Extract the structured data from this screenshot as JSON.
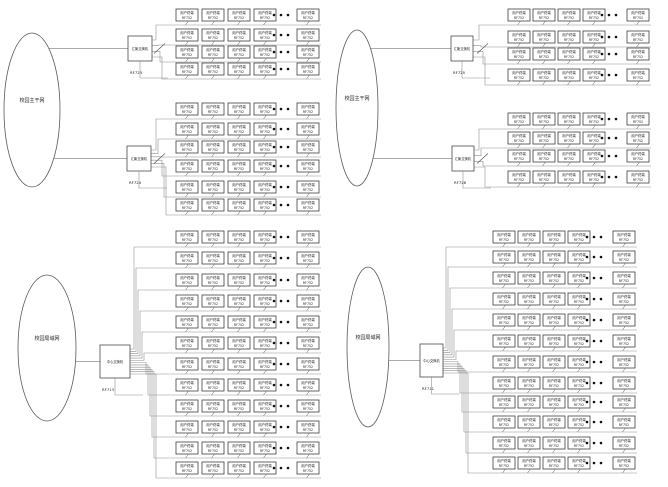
{
  "canvas": {
    "w": 668,
    "h": 487,
    "bg": "#ffffff"
  },
  "styles": {
    "wire_color": "#8f8f8f",
    "wire_width": 0.6,
    "box_stroke": "#3f3f3f",
    "box_fill": "#ffffff",
    "text_color": "#1c1c1c",
    "ellipse_stroke": "#5a5a5a",
    "dot_color": "#111111"
  },
  "terminal_box": {
    "w": 22,
    "h": 12,
    "line1": "用户终端",
    "line2": "RF752"
  },
  "clusters": [
    {
      "id": "top-left",
      "ellipse": {
        "cx": 32,
        "cy": 110,
        "rx": 28,
        "ry": 77,
        "label": "校园主干网"
      },
      "row_geo": {
        "box_xs": [
          176,
          202,
          228,
          254
        ],
        "dots_cx": 281,
        "last_x": 297,
        "bus_end": 321
      },
      "groups": [
        {
          "switch": {
            "x": 128,
            "y": 36,
            "w": 24,
            "h": 25,
            "label": "汇聚交换机",
            "sublabel": "RF723"
          },
          "riser_base": 156,
          "slash": true,
          "rows": [
            9,
            29,
            46,
            63
          ]
        },
        {
          "switch": {
            "x": 127,
            "y": 146,
            "w": 24,
            "h": 25,
            "label": "汇聚交换机",
            "sublabel": "RF724"
          },
          "riser_base": 156,
          "slash": true,
          "rows": [
            103,
            123,
            141,
            160,
            181,
            199
          ]
        }
      ]
    },
    {
      "id": "top-right",
      "ellipse": {
        "cx": 357,
        "cy": 108,
        "rx": 21,
        "ry": 78,
        "label": "校园主干网"
      },
      "row_geo": {
        "box_xs": [
          508,
          533,
          558,
          583
        ],
        "dots_cx": 609,
        "last_x": 627,
        "bus_end": 651
      },
      "groups": [
        {
          "switch": {
            "x": 451,
            "y": 36,
            "w": 22,
            "h": 25,
            "label": "汇聚交换机",
            "sublabel": "RF725"
          },
          "riser_base": 479,
          "slash": true,
          "rows": [
            9,
            31,
            48,
            69
          ]
        },
        {
          "switch": {
            "x": 452,
            "y": 146,
            "w": 22,
            "h": 25,
            "label": "汇聚交换机",
            "sublabel": "RF726"
          },
          "riser_base": 479,
          "slash": true,
          "rows": [
            113,
            132,
            150,
            171
          ]
        }
      ]
    },
    {
      "id": "bottom-left",
      "ellipse": {
        "cx": 47,
        "cy": 348,
        "rx": 29,
        "ry": 73,
        "label": "校园局域网"
      },
      "row_geo": {
        "box_xs": [
          176,
          202,
          228,
          254
        ],
        "dots_cx": 281,
        "last_x": 297,
        "bus_end": 321
      },
      "groups": [
        {
          "switch": {
            "x": 100,
            "y": 345,
            "w": 30,
            "h": 33,
            "label": "中心交换机",
            "sublabel": "RF713"
          },
          "riser_base": 134,
          "slash": false,
          "rows": [
            231,
            252,
            274,
            295,
            316,
            337,
            358,
            379,
            400,
            421,
            442,
            462
          ]
        }
      ]
    },
    {
      "id": "bottom-right",
      "ellipse": {
        "cx": 368,
        "cy": 347,
        "rx": 21,
        "ry": 80,
        "label": "校园局域网"
      },
      "row_geo": {
        "box_xs": [
          493,
          518,
          543,
          568
        ],
        "dots_cx": 594,
        "last_x": 613,
        "bus_end": 637
      },
      "groups": [
        {
          "switch": {
            "x": 420,
            "y": 344,
            "w": 23,
            "h": 33,
            "label": "中心交换机",
            "sublabel": "RF711"
          },
          "riser_base": 446,
          "slash": false,
          "rows": [
            231,
            251,
            272,
            293,
            314,
            335,
            356,
            377,
            396,
            416,
            437,
            457
          ]
        }
      ]
    }
  ]
}
